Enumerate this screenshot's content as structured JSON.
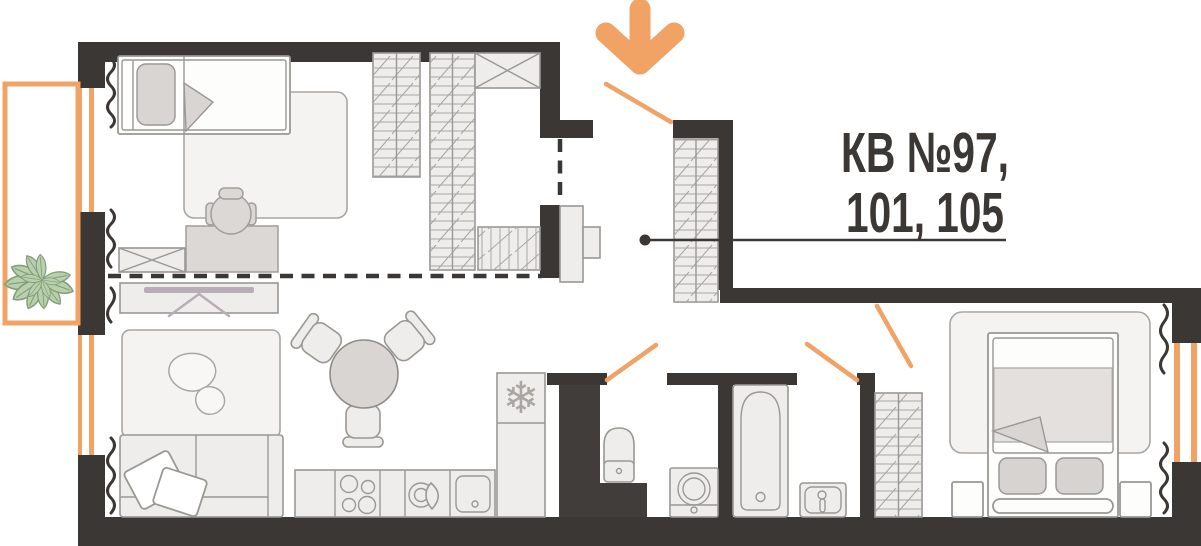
{
  "apartment_label": {
    "line1": "КВ №97,",
    "line2": "101, 105"
  },
  "entrance": {
    "icon": "arrow-down",
    "color": "#f1a265"
  },
  "icons": {
    "fridge_snowflake": "❄"
  },
  "colors": {
    "wall": "#3b3735",
    "accent_orange": "#f1a265",
    "furniture_fill": "#efedeb",
    "furniture_stroke": "#9a9894",
    "rug_fill": "#f4f3f1",
    "tv_accent": "#b9adb8",
    "plant_fill": "#b9cfad",
    "plant_stroke": "#82a078",
    "label_text": "#3b3735"
  }
}
